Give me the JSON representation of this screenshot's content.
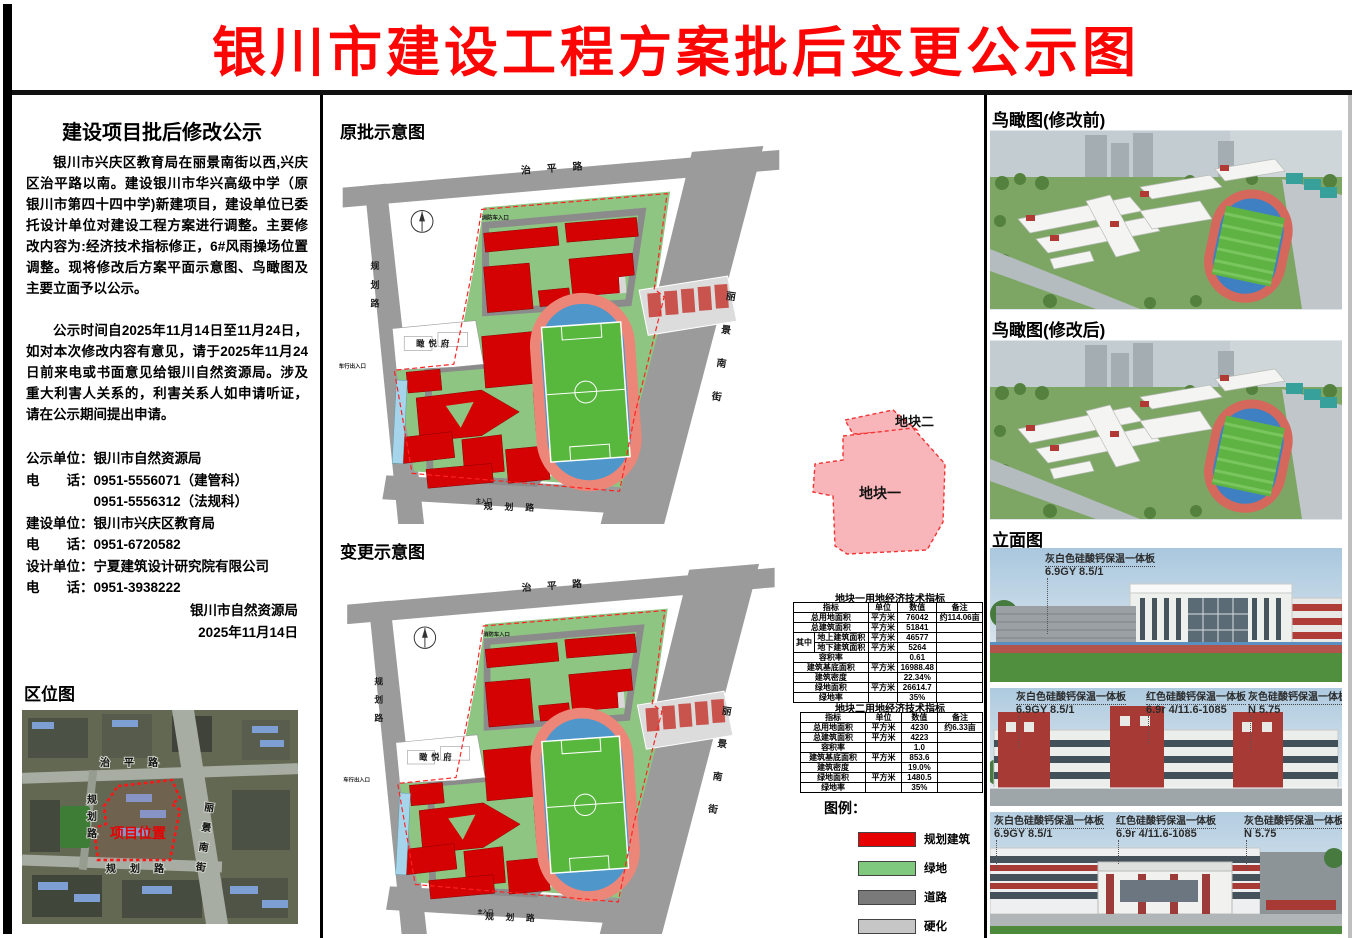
{
  "page": {
    "title": "银川市建设工程方案批后变更公示图"
  },
  "left": {
    "notice_title": "建设项目批后修改公示",
    "para1": "银川市兴庆区教育局在丽景南街以西,兴庆区治平路以南。建设银川市华兴高级中学（原银川市第四十四中学)新建项目，建设单位已委托设计单位对建设工程方案进行调整。主要修改内容为:经济技术指标修正，6#风雨操场位置调整。现将修改后方案平面示意图、鸟瞰图及主要立面予以公示。",
    "para2": "公示时间自2025年11月14日至11月24日，如对本次修改内容有意见，请于2025年11月24日前来电或书面意见给银川自然资源局。涉及重大利害人关系的，利害关系人如申请听证，请在公示期间提出申请。",
    "contact_lines": [
      "公示单位：银川市自然资源局",
      "电　　话：0951-5556071（建管科）",
      "　　　　　0951-5556312（法规科）",
      "建设单位：银川市兴庆区教育局",
      "电　　话：0951-6720582",
      "设计单位：宁夏建筑设计研究院有限公司",
      "电　　话：0951-3938222"
    ],
    "signature_org": "银川市自然资源局",
    "signature_date": "2025年11月14日",
    "location_map": {
      "title": "区位图",
      "project_label": "项目位置",
      "road_top": "治平路",
      "road_left": "规划路",
      "road_bottom": "规划路",
      "road_right": "丽景南街"
    }
  },
  "center": {
    "plan_before_title": "原批示意图",
    "plan_after_title": "变更示意图",
    "roads": {
      "top": "治平路",
      "left": "规划路",
      "right": "丽景南街",
      "bottom": "规划路"
    },
    "residence_label": "瞰悦府",
    "entrance_top": "消防车入口",
    "entrance_left": "车行出入口",
    "entrance_bottom": "主入口",
    "parcel": {
      "p1": "地块一",
      "p2": "地块二"
    },
    "table1": {
      "title": "地块一用地经济技术指标",
      "headers": [
        "指标",
        "单位",
        "数值",
        "备注"
      ],
      "group_label": "其中",
      "rows": [
        [
          "总用地面积",
          "平方米",
          "76042",
          "约114.06亩"
        ],
        [
          "总建筑面积",
          "平方米",
          "51841",
          ""
        ],
        [
          "地上建筑面积",
          "平方米",
          "46577",
          ""
        ],
        [
          "地下建筑面积",
          "平方米",
          "5264",
          ""
        ],
        [
          "容积率",
          "",
          "0.61",
          ""
        ],
        [
          "建筑基底面积",
          "平方米",
          "16988.48",
          ""
        ],
        [
          "建筑密度",
          "",
          "22.34%",
          ""
        ],
        [
          "绿地面积",
          "平方米",
          "26614.7",
          ""
        ],
        [
          "绿地率",
          "",
          "35%",
          ""
        ]
      ]
    },
    "table2": {
      "title": "地块二用地经济技术指标",
      "headers": [
        "指标",
        "单位",
        "数值",
        "备注"
      ],
      "rows": [
        [
          "总用地面积",
          "平方米",
          "4230",
          "约6.33亩"
        ],
        [
          "总建筑面积",
          "平方米",
          "4223",
          ""
        ],
        [
          "容积率",
          "",
          "1.0",
          ""
        ],
        [
          "建筑基底面积",
          "平方米",
          "853.6",
          ""
        ],
        [
          "建筑密度",
          "",
          "19.0%",
          ""
        ],
        [
          "绿地面积",
          "平方米",
          "1480.5",
          ""
        ],
        [
          "绿地率",
          "",
          "35%",
          ""
        ]
      ]
    },
    "legend": {
      "title": "图例：",
      "items": [
        {
          "label": "规划建筑",
          "color": "#e60000"
        },
        {
          "label": "绿地",
          "color": "#7fc97f"
        },
        {
          "label": "道路",
          "color": "#7a7a7a"
        },
        {
          "label": "硬化",
          "color": "#c6c6c6"
        }
      ]
    }
  },
  "right": {
    "aerial_before_title": "鸟瞰图(修改前)",
    "aerial_after_title": "鸟瞰图(修改后)",
    "elevation_title": "立面图",
    "annotations": {
      "grey_white": {
        "name": "灰白色硅酸钙保温一体板",
        "code": "6.9GY  8.5/1"
      },
      "red": {
        "name": "红色硅酸钙保温一体板",
        "code": "6.9r  4/11.6-1085"
      },
      "grey": {
        "name": "灰色硅酸钙保温一体板",
        "code": "N 5.75"
      }
    }
  }
}
